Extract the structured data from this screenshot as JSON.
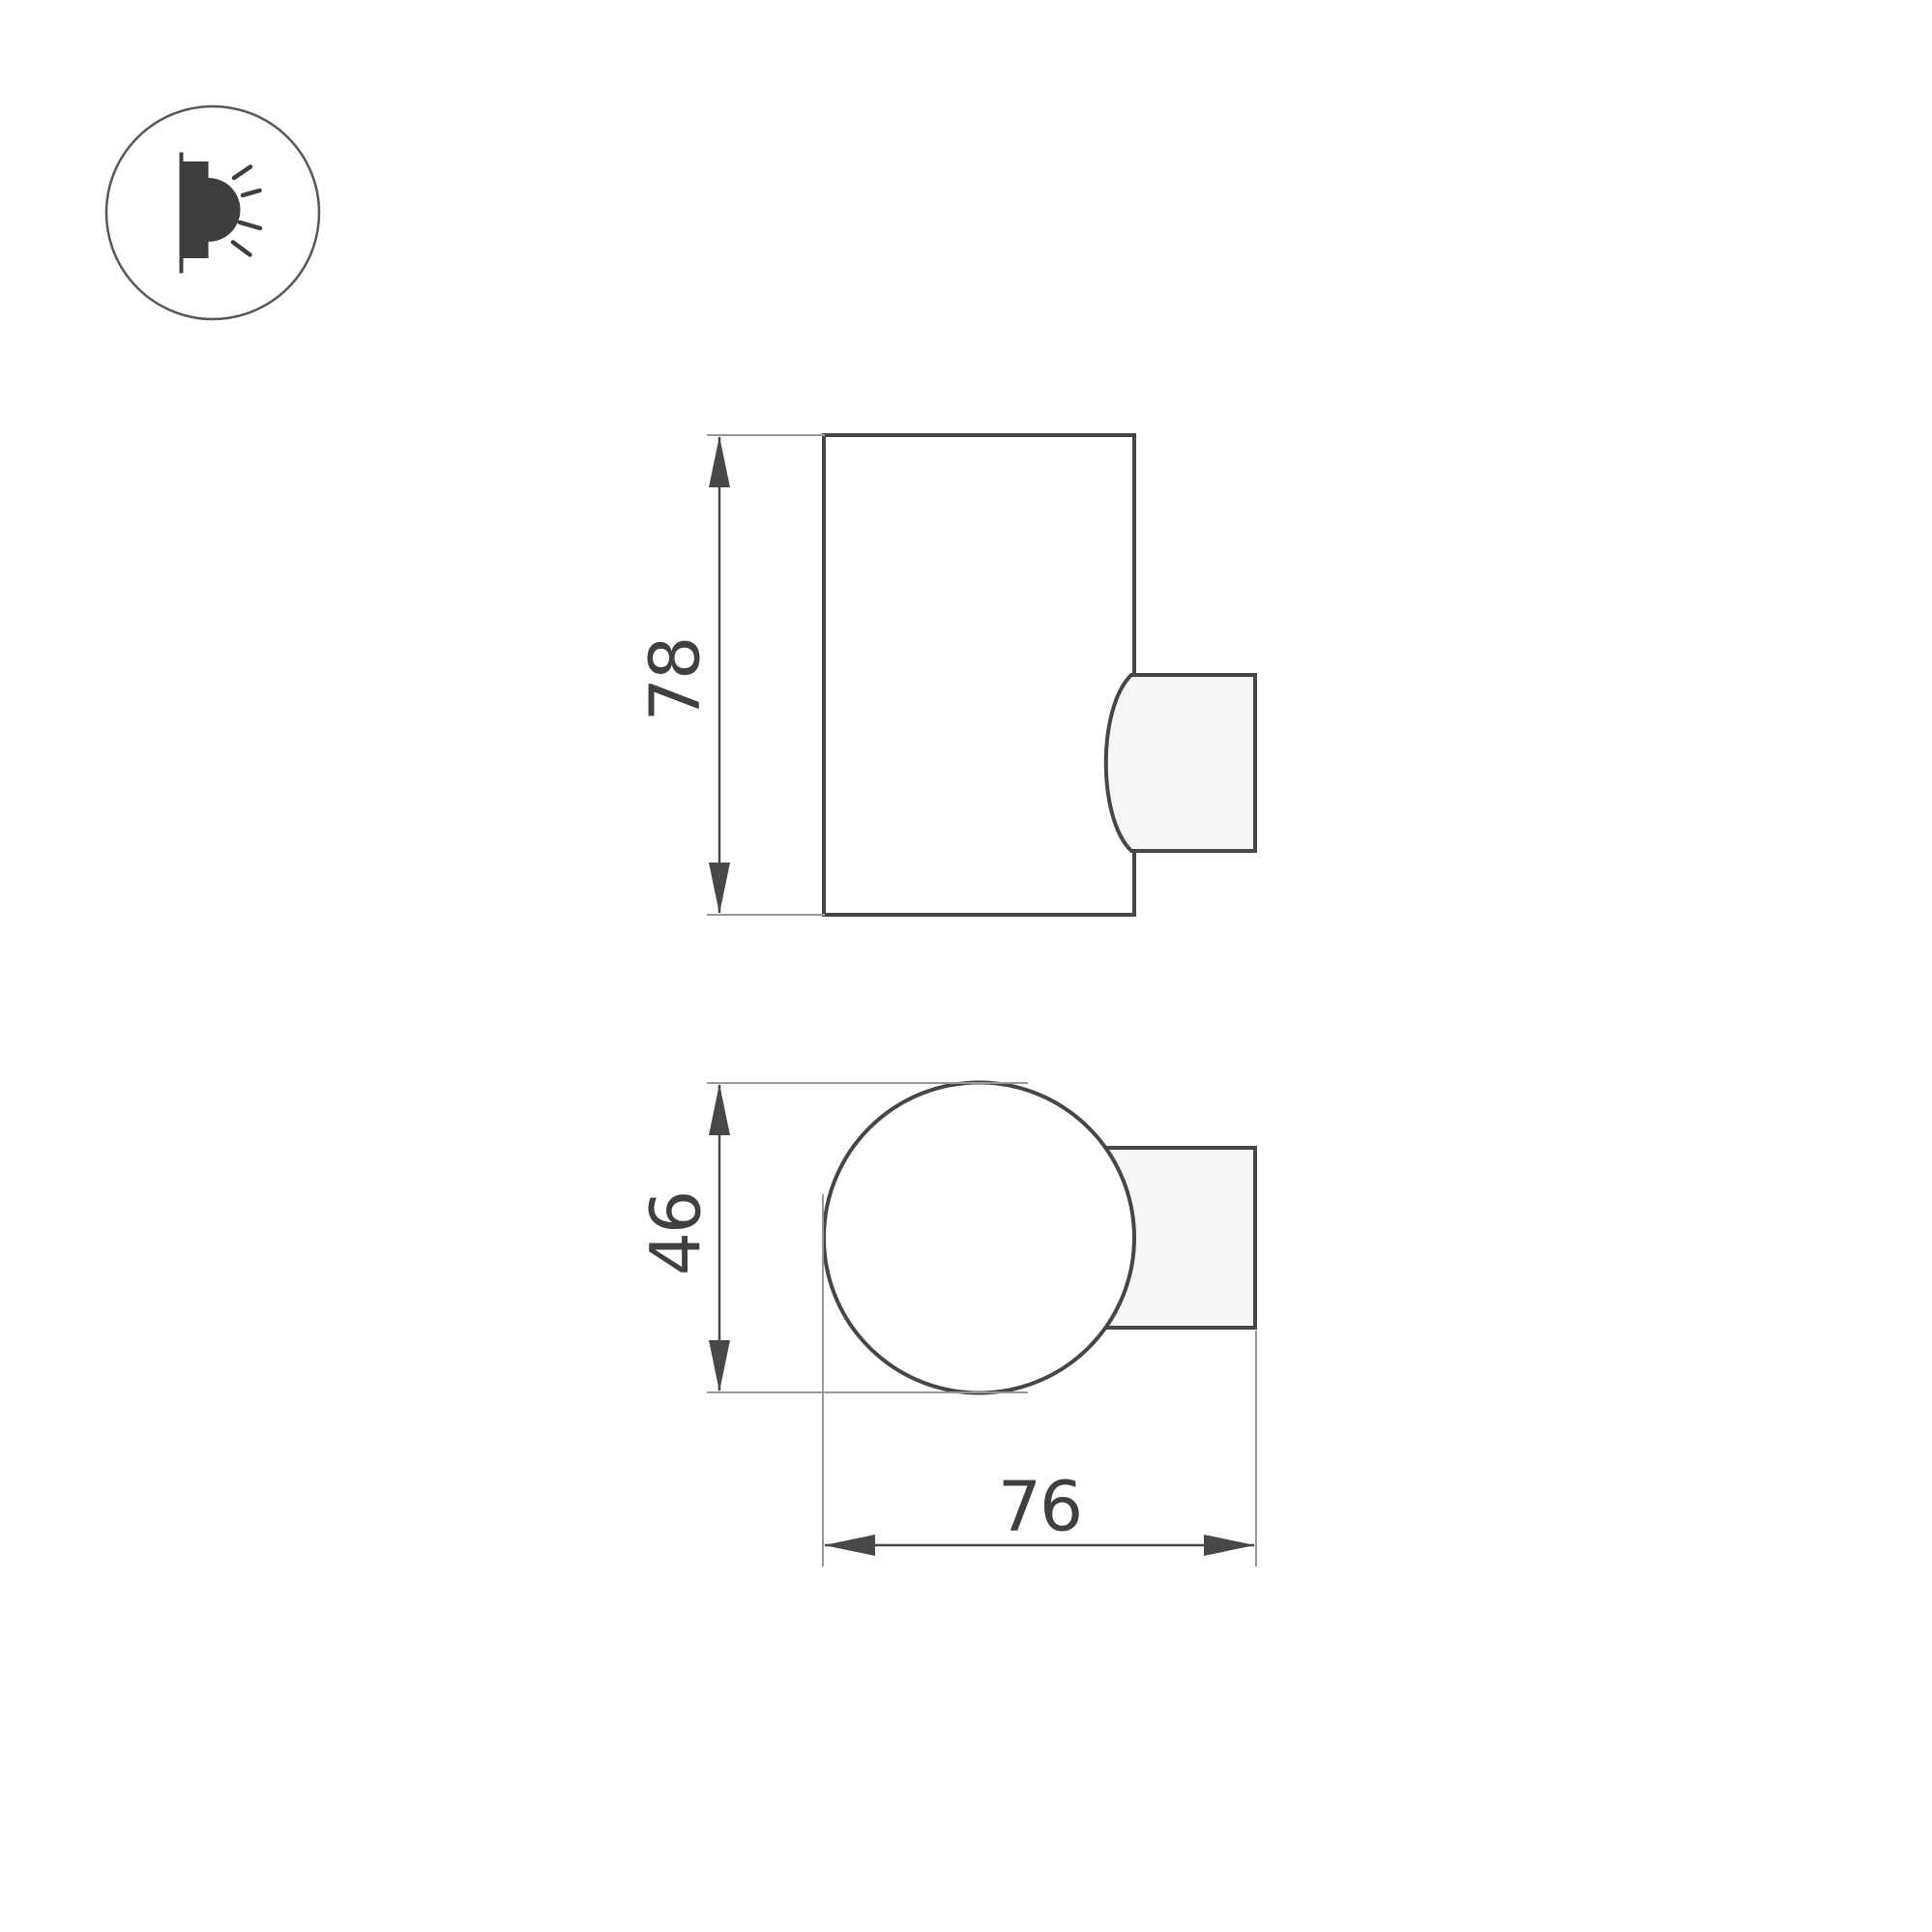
{
  "icons": {
    "wall_lamp": "wall-lamp-light-direction-icon"
  },
  "colors": {
    "background": "#ffffff",
    "part_line": "#46464a",
    "dimension_line": "#48484b",
    "extension_line": "#97979a",
    "text": "#3f4044",
    "icon": "#3e3e40",
    "icon_ring": "#56585c",
    "mount_fill": "#f6f6f8",
    "body_fill": "#ffffff"
  },
  "figures": {
    "side_view": {
      "description": "side view of cylindrical wall lamp with wall mount bracket on right"
    },
    "top_view": {
      "description": "top view of spherical lamp body with wall mount bracket on right"
    }
  },
  "dimensions": {
    "height": {
      "value": "78"
    },
    "diameter": {
      "value": "46"
    },
    "depth": {
      "value": "76"
    }
  }
}
